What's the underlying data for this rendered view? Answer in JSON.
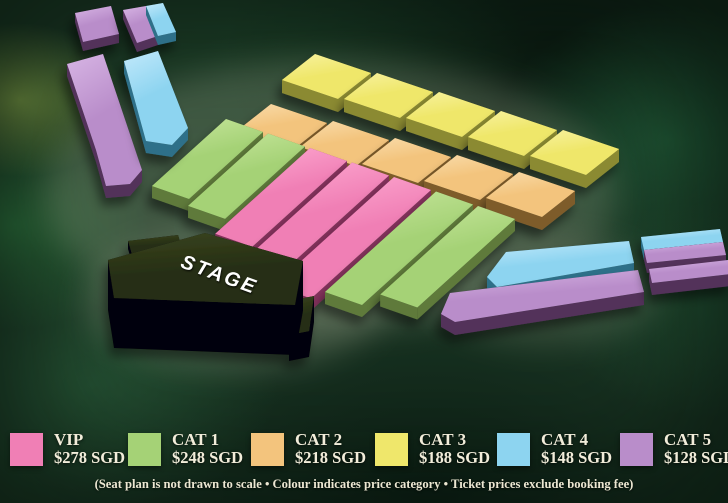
{
  "legend": {
    "items": [
      {
        "name": "VIP",
        "price": "$278 SGD",
        "color": "#f07fb5",
        "highlight": "#ffaed4",
        "shadow_side": "#84335c"
      },
      {
        "name": "CAT 1",
        "price": "$248 SGD",
        "color": "#a5d276",
        "highlight": "#c9e79f",
        "shadow_side": "#5e7a3a"
      },
      {
        "name": "CAT 2",
        "price": "$218 SGD",
        "color": "#f3c47d",
        "highlight": "#f9dcab",
        "shadow_side": "#7e5c2c"
      },
      {
        "name": "CAT 3",
        "price": "$188 SGD",
        "color": "#efe76b",
        "highlight": "#f8f2a0",
        "shadow_side": "#8b8a31"
      },
      {
        "name": "CAT 4",
        "price": "$148 SGD",
        "color": "#8dd4f0",
        "highlight": "#c2e9fb",
        "shadow_side": "#2e7089"
      },
      {
        "name": "CAT 5",
        "price": "$128 SGD",
        "color": "#b98dca",
        "highlight": "#d7b5e4",
        "shadow_side": "#53305a"
      }
    ]
  },
  "stage": {
    "label": "STAGE",
    "top_color": "#262e13",
    "top_highlight": "#39441f",
    "front_color": "#060608",
    "label_color": "#ffffff"
  },
  "footnote": "(Seat plan is not drawn to scale • Colour indicates price category • Ticket prices exclude booking fee)",
  "seat_map": {
    "blocks": [
      {
        "id": "back-yellow-1",
        "categories": [
          "CAT 3"
        ]
      },
      {
        "id": "back-yellow-2",
        "categories": [
          "CAT 3"
        ]
      },
      {
        "id": "back-yellow-3",
        "categories": [
          "CAT 3"
        ]
      },
      {
        "id": "back-yellow-4",
        "categories": [
          "CAT 3"
        ]
      },
      {
        "id": "back-yellow-5",
        "categories": [
          "CAT 3"
        ]
      },
      {
        "id": "back-orange-1",
        "categories": [
          "CAT 2"
        ]
      },
      {
        "id": "back-orange-2",
        "categories": [
          "CAT 2"
        ]
      },
      {
        "id": "back-orange-3",
        "categories": [
          "CAT 2"
        ]
      },
      {
        "id": "back-orange-4",
        "categories": [
          "CAT 2"
        ]
      },
      {
        "id": "back-orange-5",
        "categories": [
          "CAT 2"
        ]
      },
      {
        "id": "floor-1",
        "categories": [
          "CAT 1"
        ]
      },
      {
        "id": "floor-2",
        "categories": [
          "CAT 1"
        ]
      },
      {
        "id": "floor-3",
        "categories": [
          "VIP"
        ]
      },
      {
        "id": "floor-4",
        "categories": [
          "VIP"
        ]
      },
      {
        "id": "floor-5",
        "categories": [
          "VIP"
        ]
      },
      {
        "id": "floor-6",
        "categories": [
          "CAT 1"
        ]
      },
      {
        "id": "floor-7",
        "categories": [
          "CAT 1"
        ]
      },
      {
        "id": "left-bar-small",
        "categories": [
          "CAT 5"
        ]
      },
      {
        "id": "left-bar-split",
        "categories": [
          "CAT 5",
          "CAT 4"
        ]
      },
      {
        "id": "left-bar-long",
        "categories": [
          "CAT 5"
        ]
      },
      {
        "id": "left-bar-blue",
        "categories": [
          "CAT 4"
        ]
      },
      {
        "id": "right-bar-blue",
        "categories": [
          "CAT 4"
        ]
      },
      {
        "id": "right-bar-purple",
        "categories": [
          "CAT 5"
        ]
      },
      {
        "id": "right-small-split",
        "categories": [
          "CAT 4",
          "CAT 5"
        ]
      },
      {
        "id": "right-small-purple",
        "categories": [
          "CAT 5"
        ]
      }
    ]
  }
}
